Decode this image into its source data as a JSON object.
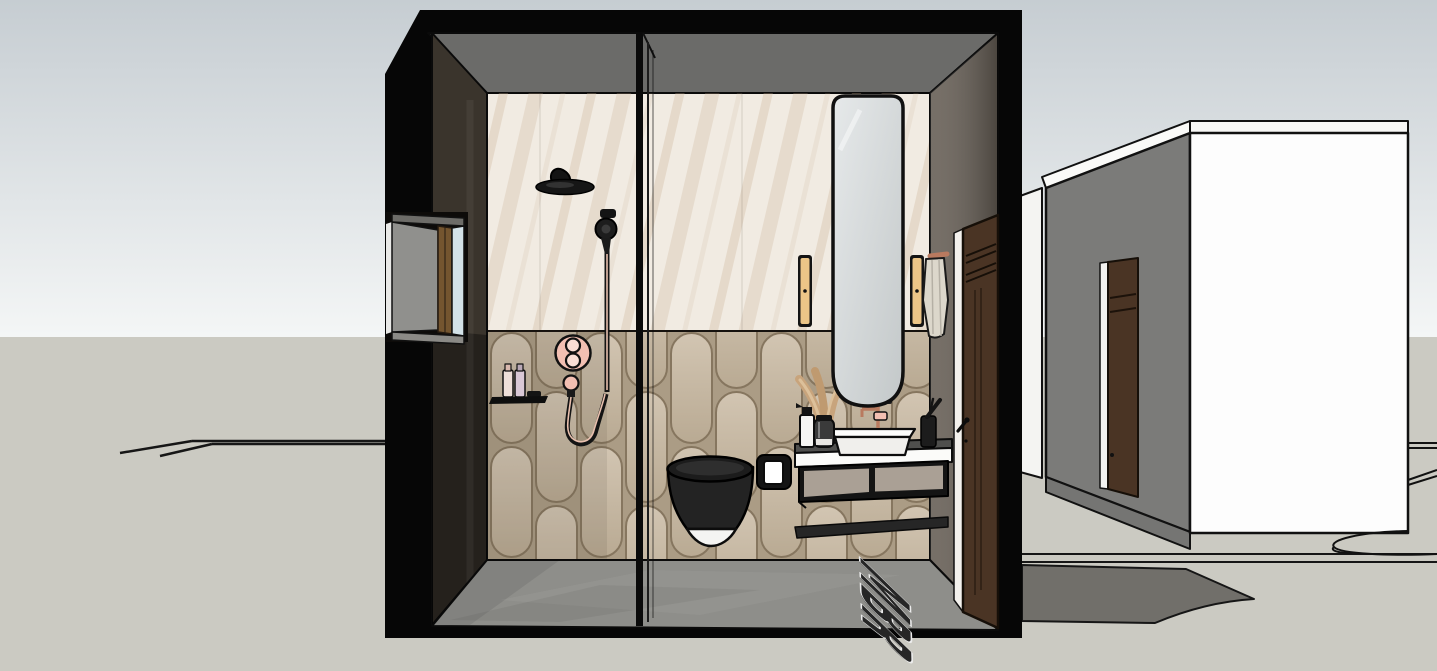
{
  "scene": {
    "mat_label": "MBR"
  },
  "colors": {
    "sky_top": "#c6cdd2",
    "sky_bottom": "#f4f6f6",
    "ground": "#cbcac2",
    "section_black": "#060606",
    "ceiling": "#6b6b69",
    "marble_base": "#f1ebe2",
    "tile_fill_top": "#d2c5b2",
    "tile_fill_bottom": "#b9aa93",
    "tile_grout": "#ab9c85",
    "tile_line": "#86765f",
    "floor": "#8e8e8a",
    "left_wall": "#3a342c",
    "right_wall": "#675f56",
    "window_glass": "#d3e2e8",
    "window_wood": "#74552f",
    "accent_pink": "#f2bfb2",
    "accent_pink_light": "#f9ddd4",
    "copper": "#e9c0ae",
    "fixture_black": "#232323",
    "porcelain_white": "#f4f4f2",
    "counter_white": "#fbfbf9",
    "drawer_front": "#aaa095",
    "bench_dark": "#262626",
    "mirror_glass": "#d9dddd",
    "sconce_amber": "#ecc587",
    "towel": "#dcd7cb",
    "door_wood": "#4a3424",
    "door_trim": "#f3f1ed",
    "annex_gray_wall": "#7b7b79",
    "annex_white_wall": "#fdfdfd",
    "annex_sliver": "#f4f4f2",
    "annex_door_wood": "#4a3424",
    "floor_patch": "#716f6a",
    "mat_letter_fill": "#262626",
    "mat_letter_stroke": "#ececec"
  }
}
